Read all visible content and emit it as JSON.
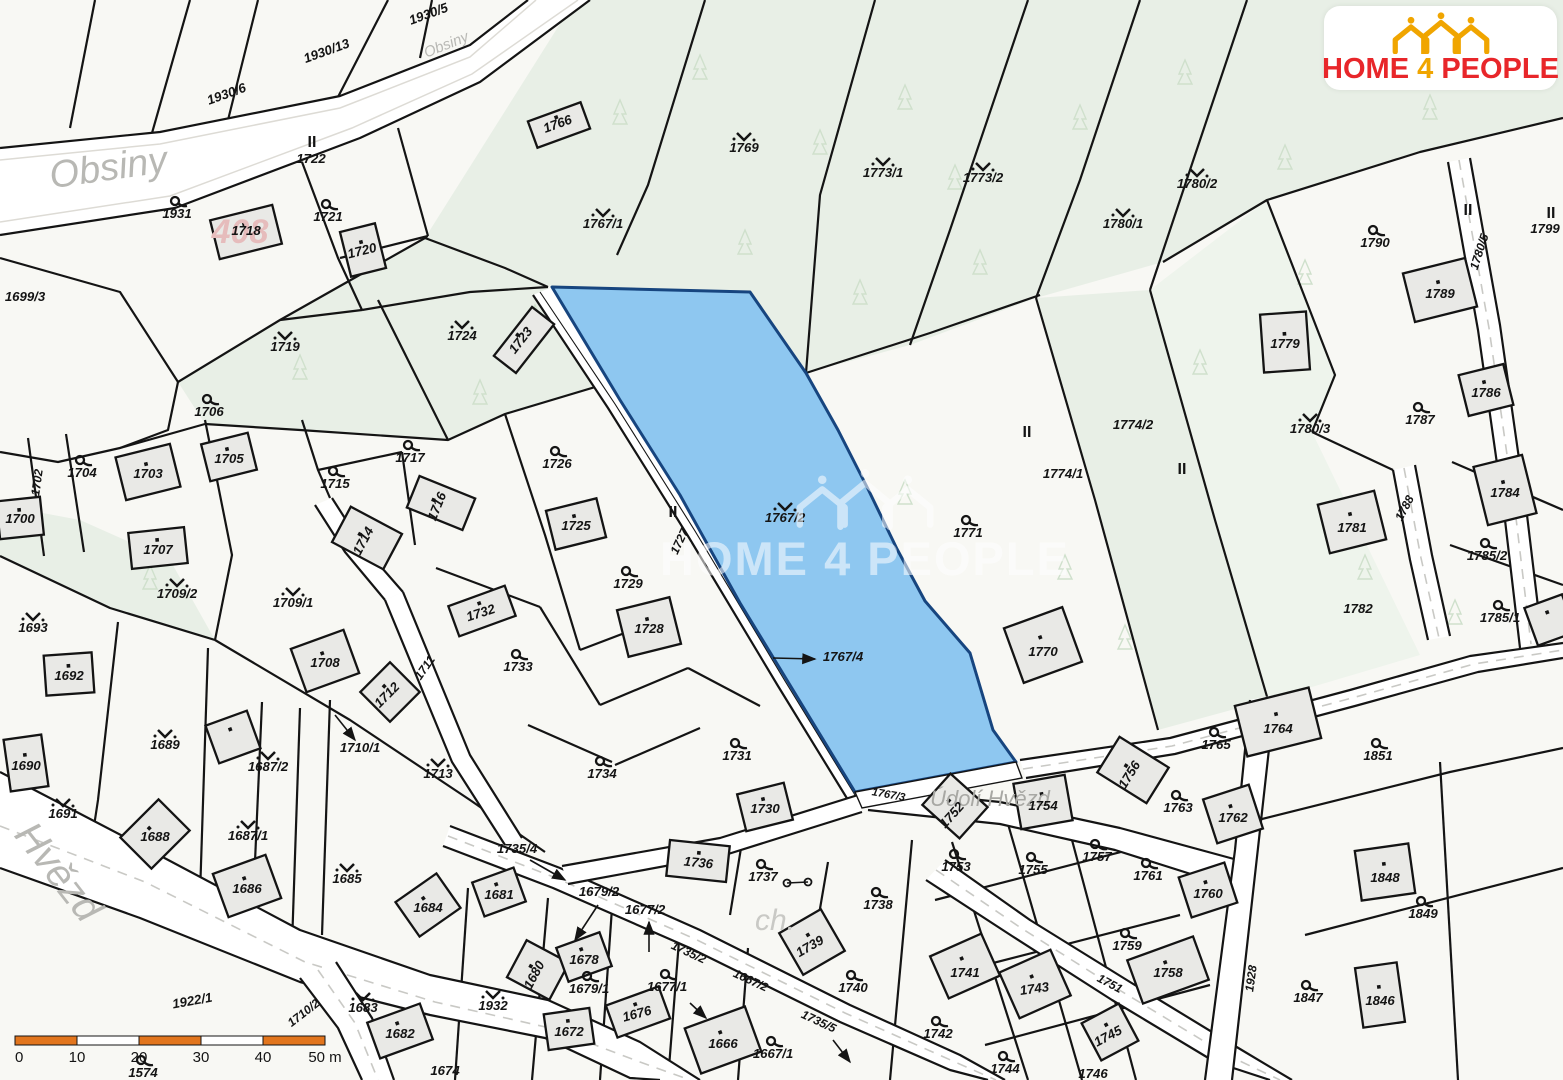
{
  "branding": {
    "logo": {
      "home": "HOME",
      "four": "4",
      "people": "PEOPLE"
    },
    "watermark": "HOME 4 PEOPLE"
  },
  "colors": {
    "highlight_fill": "#8ec7f0",
    "highlight_stroke": "#17457f",
    "green": "#e8efe6",
    "green_pale": "#eef4ec",
    "road_white": "#ffffff",
    "line": "#141414",
    "scale_orange": "#e2751d",
    "logo_red": "#e8262a",
    "logo_yellow": "#f0a500",
    "street_gray": "#b8b8b4"
  },
  "highlight": {
    "parcel": "1767/2",
    "related": [
      "1767/4",
      "1767/3"
    ]
  },
  "scale_bar": {
    "ticks": [
      "0",
      "10",
      "20",
      "30",
      "40",
      "50 m"
    ]
  },
  "map": {
    "labels": [
      {
        "t": "Obsiny",
        "x": 110,
        "y": 180,
        "r": -8,
        "s": 38,
        "c": "#b8b8b4",
        "b": false
      },
      {
        "t": "Obsiny",
        "x": 448,
        "y": 49,
        "r": -22,
        "s": 15,
        "c": "#b8b8b4",
        "b": false
      },
      {
        "t": "Hvězd",
        "x": 48,
        "y": 880,
        "r": 52,
        "s": 40,
        "c": "#b8b8b4",
        "b": false
      },
      {
        "t": "Údolí Hvězd",
        "x": 990,
        "y": 806,
        "r": 0,
        "s": 22,
        "c": "#a8a8a4",
        "b": false
      },
      {
        "t": "ch.",
        "x": 775,
        "y": 930,
        "r": 0,
        "s": 30,
        "c": "#c9c9c5",
        "b": false
      },
      {
        "t": "408",
        "x": 240,
        "y": 243,
        "r": 0,
        "s": 34,
        "c": "#e6bcbc"
      },
      {
        "t": "1931",
        "x": 177,
        "y": 218,
        "sym": "g"
      },
      {
        "t": "1721",
        "x": 328,
        "y": 221,
        "sym": "g"
      },
      {
        "t": "1704",
        "x": 82,
        "y": 477,
        "sym": "g"
      },
      {
        "t": "1706",
        "x": 209,
        "y": 416,
        "sym": "g"
      },
      {
        "t": "1715",
        "x": 335,
        "y": 488,
        "sym": "g"
      },
      {
        "t": "1717",
        "x": 410,
        "y": 462,
        "sym": "g"
      },
      {
        "t": "1726",
        "x": 557,
        "y": 468,
        "sym": "g"
      },
      {
        "t": "1729",
        "x": 628,
        "y": 588,
        "sym": "g"
      },
      {
        "t": "1733",
        "x": 518,
        "y": 671,
        "sym": "g"
      },
      {
        "t": "1734",
        "x": 602,
        "y": 778,
        "sym": "g"
      },
      {
        "t": "1731",
        "x": 737,
        "y": 760,
        "sym": "g"
      },
      {
        "t": "1737",
        "x": 763,
        "y": 881,
        "sym": "g"
      },
      {
        "t": "1738",
        "x": 878,
        "y": 909,
        "sym": "g"
      },
      {
        "t": "1740",
        "x": 853,
        "y": 992,
        "sym": "g"
      },
      {
        "t": "1742",
        "x": 938,
        "y": 1038,
        "sym": "g"
      },
      {
        "t": "1744",
        "x": 1005,
        "y": 1073,
        "sym": "g"
      },
      {
        "t": "1679/1",
        "x": 589,
        "y": 993,
        "sym": "g"
      },
      {
        "t": "1677/1",
        "x": 667,
        "y": 991,
        "sym": "g"
      },
      {
        "t": "1667/1",
        "x": 773,
        "y": 1058,
        "sym": "g"
      },
      {
        "t": "1753",
        "x": 956,
        "y": 871,
        "sym": "g"
      },
      {
        "t": "1755",
        "x": 1033,
        "y": 874,
        "sym": "g"
      },
      {
        "t": "1757",
        "x": 1097,
        "y": 861,
        "sym": "g"
      },
      {
        "t": "1759",
        "x": 1127,
        "y": 950,
        "sym": "g"
      },
      {
        "t": "1761",
        "x": 1148,
        "y": 880,
        "sym": "g"
      },
      {
        "t": "1763",
        "x": 1178,
        "y": 812,
        "sym": "g"
      },
      {
        "t": "1765",
        "x": 1216,
        "y": 749,
        "sym": "g"
      },
      {
        "t": "1771",
        "x": 968,
        "y": 537,
        "sym": "g"
      },
      {
        "t": "1787",
        "x": 1420,
        "y": 424,
        "sym": "g"
      },
      {
        "t": "1849",
        "x": 1423,
        "y": 918,
        "sym": "g"
      },
      {
        "t": "1847",
        "x": 1308,
        "y": 1002,
        "sym": "g"
      },
      {
        "t": "1851",
        "x": 1378,
        "y": 760,
        "sym": "g"
      },
      {
        "t": "1785/2",
        "x": 1487,
        "y": 560,
        "sym": "g"
      },
      {
        "t": "1785/1",
        "x": 1500,
        "y": 622,
        "sym": "g"
      },
      {
        "t": "1790",
        "x": 1375,
        "y": 247,
        "sym": "g"
      },
      {
        "t": "1574",
        "x": 143,
        "y": 1077,
        "sym": "g"
      },
      {
        "t": "1719",
        "x": 285,
        "y": 351,
        "sym": "m"
      },
      {
        "t": "1724",
        "x": 462,
        "y": 340,
        "sym": "m"
      },
      {
        "t": "1693",
        "x": 33,
        "y": 632,
        "sym": "m"
      },
      {
        "t": "1691",
        "x": 63,
        "y": 818,
        "sym": "m"
      },
      {
        "t": "1689",
        "x": 165,
        "y": 749,
        "sym": "m"
      },
      {
        "t": "1685",
        "x": 347,
        "y": 883,
        "sym": "m"
      },
      {
        "t": "1687/2",
        "x": 268,
        "y": 771,
        "sym": "m"
      },
      {
        "t": "1687/1",
        "x": 248,
        "y": 840,
        "sym": "m"
      },
      {
        "t": "1709/2",
        "x": 177,
        "y": 598,
        "sym": "m"
      },
      {
        "t": "1709/1",
        "x": 293,
        "y": 607,
        "sym": "m"
      },
      {
        "t": "1713",
        "x": 438,
        "y": 778,
        "sym": "m"
      },
      {
        "t": "1767/1",
        "x": 603,
        "y": 228,
        "sym": "m"
      },
      {
        "t": "1767/2",
        "x": 785,
        "y": 522,
        "sym": "m"
      },
      {
        "t": "1769",
        "x": 744,
        "y": 152,
        "sym": "m"
      },
      {
        "t": "1773/1",
        "x": 883,
        "y": 177,
        "sym": "m"
      },
      {
        "t": "1773/2",
        "x": 983,
        "y": 182,
        "sym": "m"
      },
      {
        "t": "1780/1",
        "x": 1123,
        "y": 228,
        "sym": "m"
      },
      {
        "t": "1780/2",
        "x": 1197,
        "y": 188,
        "sym": "m"
      },
      {
        "t": "1780/3",
        "x": 1310,
        "y": 433,
        "sym": "m"
      },
      {
        "t": "1683",
        "x": 363,
        "y": 1012,
        "sym": "m"
      },
      {
        "t": "1932",
        "x": 493,
        "y": 1010,
        "sym": "m"
      },
      {
        "t": "II",
        "x": 312,
        "y": 147,
        "s": 16,
        "i": false
      },
      {
        "t": "II",
        "x": 673,
        "y": 517,
        "s": 16,
        "i": false
      },
      {
        "t": "II",
        "x": 1027,
        "y": 437,
        "s": 16,
        "i": false
      },
      {
        "t": "II",
        "x": 1182,
        "y": 474,
        "s": 16,
        "i": false
      },
      {
        "t": "II",
        "x": 1468,
        "y": 215,
        "s": 16,
        "i": false
      },
      {
        "t": "II",
        "x": 1551,
        "y": 218,
        "s": 16,
        "i": false
      },
      {
        "t": "1722",
        "x": 311,
        "y": 163
      },
      {
        "t": "1799",
        "x": 1545,
        "y": 233
      },
      {
        "t": "1699/3",
        "x": 25,
        "y": 301
      },
      {
        "t": "1718",
        "x": 246,
        "y": 235
      },
      {
        "t": "1720",
        "x": 363,
        "y": 255,
        "r": -14
      },
      {
        "t": "1723",
        "x": 524,
        "y": 343,
        "r": -52
      },
      {
        "t": "1703",
        "x": 148,
        "y": 478
      },
      {
        "t": "1705",
        "x": 229,
        "y": 463
      },
      {
        "t": "1700",
        "x": 20,
        "y": 523
      },
      {
        "t": "1702",
        "x": 41,
        "y": 483,
        "r": -82,
        "s": 12
      },
      {
        "t": "1707",
        "x": 158,
        "y": 554
      },
      {
        "t": "1714",
        "x": 367,
        "y": 543,
        "r": -62
      },
      {
        "t": "1716",
        "x": 441,
        "y": 508,
        "r": -68
      },
      {
        "t": "1725",
        "x": 576,
        "y": 530
      },
      {
        "t": "1728",
        "x": 649,
        "y": 633
      },
      {
        "t": "1732",
        "x": 482,
        "y": 617,
        "r": -18
      },
      {
        "t": "1708",
        "x": 325,
        "y": 667
      },
      {
        "t": "1712",
        "x": 390,
        "y": 698,
        "r": -45
      },
      {
        "t": "1710/1",
        "x": 360,
        "y": 752
      },
      {
        "t": "1692",
        "x": 69,
        "y": 680
      },
      {
        "t": "1690",
        "x": 26,
        "y": 770
      },
      {
        "t": "1688",
        "x": 155,
        "y": 841
      },
      {
        "t": "1686",
        "x": 247,
        "y": 893
      },
      {
        "t": "1684",
        "x": 428,
        "y": 912
      },
      {
        "t": "1682",
        "x": 400,
        "y": 1038
      },
      {
        "t": "1681",
        "x": 499,
        "y": 899
      },
      {
        "t": "1680",
        "x": 538,
        "y": 977,
        "r": -62
      },
      {
        "t": "1678",
        "x": 584,
        "y": 964
      },
      {
        "t": "1676",
        "x": 638,
        "y": 1018,
        "r": -15
      },
      {
        "t": "1672",
        "x": 569,
        "y": 1036
      },
      {
        "t": "1666",
        "x": 723,
        "y": 1048
      },
      {
        "t": "1736",
        "x": 698,
        "y": 867,
        "r": 6
      },
      {
        "t": "1739",
        "x": 812,
        "y": 950,
        "r": -30
      },
      {
        "t": "1730",
        "x": 765,
        "y": 813
      },
      {
        "t": "1758",
        "x": 1168,
        "y": 977
      },
      {
        "t": "1760",
        "x": 1208,
        "y": 898
      },
      {
        "t": "1762",
        "x": 1233,
        "y": 822
      },
      {
        "t": "1764",
        "x": 1278,
        "y": 733
      },
      {
        "t": "1756",
        "x": 1133,
        "y": 777,
        "r": -58
      },
      {
        "t": "1754",
        "x": 1043,
        "y": 810
      },
      {
        "t": "1752",
        "x": 955,
        "y": 818,
        "r": -48
      },
      {
        "t": "1770",
        "x": 1043,
        "y": 656
      },
      {
        "t": "1781",
        "x": 1352,
        "y": 532
      },
      {
        "t": "1782",
        "x": 1358,
        "y": 613
      },
      {
        "t": "1779",
        "x": 1285,
        "y": 348
      },
      {
        "t": "1789",
        "x": 1440,
        "y": 298
      },
      {
        "t": "1786",
        "x": 1486,
        "y": 397
      },
      {
        "t": "1784",
        "x": 1505,
        "y": 497
      },
      {
        "t": "1848",
        "x": 1385,
        "y": 882
      },
      {
        "t": "1846",
        "x": 1380,
        "y": 1005
      },
      {
        "t": "1745",
        "x": 1110,
        "y": 1040,
        "r": -28
      },
      {
        "t": "1741",
        "x": 965,
        "y": 977
      },
      {
        "t": "1743",
        "x": 1035,
        "y": 993,
        "r": -8
      },
      {
        "t": "1746",
        "x": 1093,
        "y": 1078
      },
      {
        "t": "1766",
        "x": 559,
        "y": 128,
        "r": -20
      },
      {
        "t": "1767/4",
        "x": 843,
        "y": 661
      },
      {
        "t": "1774/1",
        "x": 1063,
        "y": 478
      },
      {
        "t": "1774/2",
        "x": 1133,
        "y": 429
      },
      {
        "t": "1735/4",
        "x": 517,
        "y": 853
      },
      {
        "t": "1679/2",
        "x": 599,
        "y": 896
      },
      {
        "t": "1677/2",
        "x": 645,
        "y": 914
      },
      {
        "t": "1674",
        "x": 445,
        "y": 1075
      },
      {
        "t": "1930/6",
        "x": 228,
        "y": 98,
        "r": -20
      },
      {
        "t": "1930/13",
        "x": 328,
        "y": 55,
        "r": -20
      },
      {
        "t": "1930/5",
        "x": 430,
        "y": 18,
        "r": -20
      },
      {
        "t": "1922/1",
        "x": 193,
        "y": 1005,
        "r": -10
      },
      {
        "t": "1710/2",
        "x": 306,
        "y": 1016,
        "r": -38,
        "s": 12
      },
      {
        "t": "1751",
        "x": 1108,
        "y": 987,
        "r": 28,
        "s": 12
      },
      {
        "t": "1928",
        "x": 1255,
        "y": 979,
        "r": -82,
        "s": 12
      },
      {
        "t": "1788",
        "x": 1408,
        "y": 510,
        "r": -62,
        "s": 12
      },
      {
        "t": "1780/5",
        "x": 1483,
        "y": 253,
        "r": -72,
        "s": 12
      },
      {
        "t": "1727",
        "x": 683,
        "y": 543,
        "r": -65,
        "s": 12
      },
      {
        "t": "1711",
        "x": 428,
        "y": 670,
        "r": -55,
        "s": 12
      },
      {
        "t": "1767/3",
        "x": 888,
        "y": 798,
        "r": 10,
        "s": 11
      },
      {
        "t": "1735/2",
        "x": 687,
        "y": 956,
        "r": 25,
        "s": 12
      },
      {
        "t": "1667/2",
        "x": 749,
        "y": 984,
        "r": 25,
        "s": 12
      },
      {
        "t": "1735/5",
        "x": 817,
        "y": 1025,
        "r": 25,
        "s": 12
      }
    ]
  }
}
